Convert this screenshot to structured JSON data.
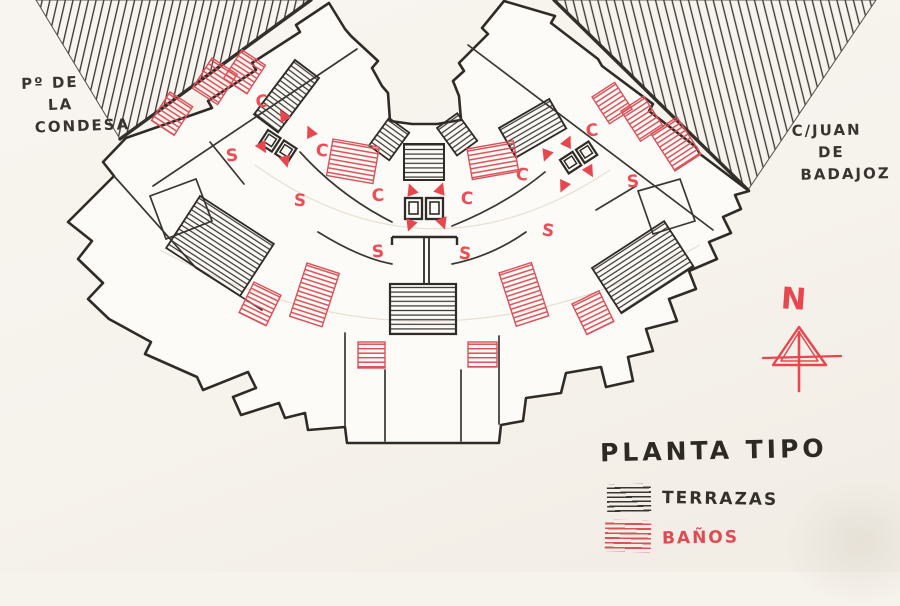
{
  "title": "PLANTA TIPO",
  "streets": {
    "left": {
      "line1": "Pº DE",
      "line2": "LA",
      "line3": "CONDESA"
    },
    "right": {
      "line1": "C/JUAN",
      "line2": "DE",
      "line3": "BADAJOZ"
    }
  },
  "legend": {
    "terraces_label": "TERRAZAS",
    "baths_label": "BAÑOS"
  },
  "north": {
    "label": "N"
  },
  "colors": {
    "ink": "#2f2b27",
    "red": "#e8474f",
    "red_hatch": "#dd5058",
    "paper": "#f8f5f0"
  },
  "annotations": {
    "letters": [
      {
        "ch": "C",
        "x": 262,
        "y": 103,
        "r": -8
      },
      {
        "ch": "C",
        "x": 322,
        "y": 152,
        "r": 6
      },
      {
        "ch": "C",
        "x": 378,
        "y": 197,
        "r": -4
      },
      {
        "ch": "C",
        "x": 467,
        "y": 200,
        "r": 3
      },
      {
        "ch": "C",
        "x": 522,
        "y": 176,
        "r": 8
      },
      {
        "ch": "C",
        "x": 592,
        "y": 132,
        "r": -6
      },
      {
        "ch": "S",
        "x": 232,
        "y": 157,
        "r": -5
      },
      {
        "ch": "S",
        "x": 300,
        "y": 202,
        "r": 4
      },
      {
        "ch": "S",
        "x": 378,
        "y": 253,
        "r": -3
      },
      {
        "ch": "S",
        "x": 465,
        "y": 255,
        "r": 5
      },
      {
        "ch": "S",
        "x": 548,
        "y": 232,
        "r": 8
      },
      {
        "ch": "S",
        "x": 633,
        "y": 183,
        "r": -4
      }
    ],
    "arrows": [
      {
        "x": 283,
        "y": 115,
        "a": -30
      },
      {
        "x": 310,
        "y": 131,
        "a": -25
      },
      {
        "x": 263,
        "y": 148,
        "a": 150
      },
      {
        "x": 286,
        "y": 162,
        "a": 165
      },
      {
        "x": 411,
        "y": 189,
        "a": -20
      },
      {
        "x": 441,
        "y": 188,
        "a": 20
      },
      {
        "x": 410,
        "y": 226,
        "a": 200
      },
      {
        "x": 443,
        "y": 224,
        "a": 160
      },
      {
        "x": 568,
        "y": 141,
        "a": 25
      },
      {
        "x": 546,
        "y": 156,
        "a": 200
      },
      {
        "x": 590,
        "y": 172,
        "a": 150
      },
      {
        "x": 563,
        "y": 187,
        "a": 205
      }
    ]
  }
}
